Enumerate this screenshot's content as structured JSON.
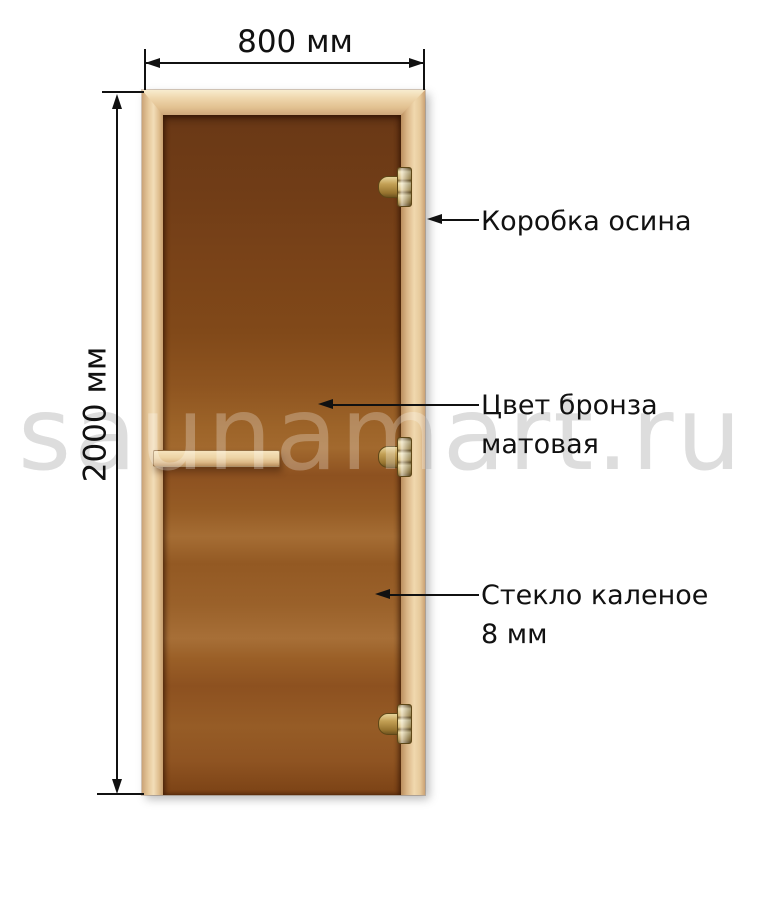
{
  "page": {
    "background_color": "#ffffff",
    "watermark_text": "saunamart.ru",
    "watermark_color": "#d2d2d2",
    "text_color": "#111111"
  },
  "dimensions": {
    "width": {
      "label": "800 мм"
    },
    "height": {
      "label": "2000 мм"
    }
  },
  "callouts": [
    {
      "id": "frame",
      "lines": [
        "Коробка осина"
      ]
    },
    {
      "id": "glass-color",
      "lines": [
        "Цвет бронза",
        "матовая"
      ]
    },
    {
      "id": "glass-type",
      "lines": [
        "Стекло каленое",
        "8 мм"
      ]
    }
  ],
  "door": {
    "parts": {
      "frame": "frame-aspen",
      "glass": "glass-bronze-matte",
      "handle": "wooden-handle",
      "hinges": "brass-hinge"
    },
    "hinge_count": 3,
    "colors": {
      "frame_wood": "#ecd2a8",
      "glass_bronze": "#8a4f22",
      "hinge_brass": "#c3a055"
    }
  }
}
